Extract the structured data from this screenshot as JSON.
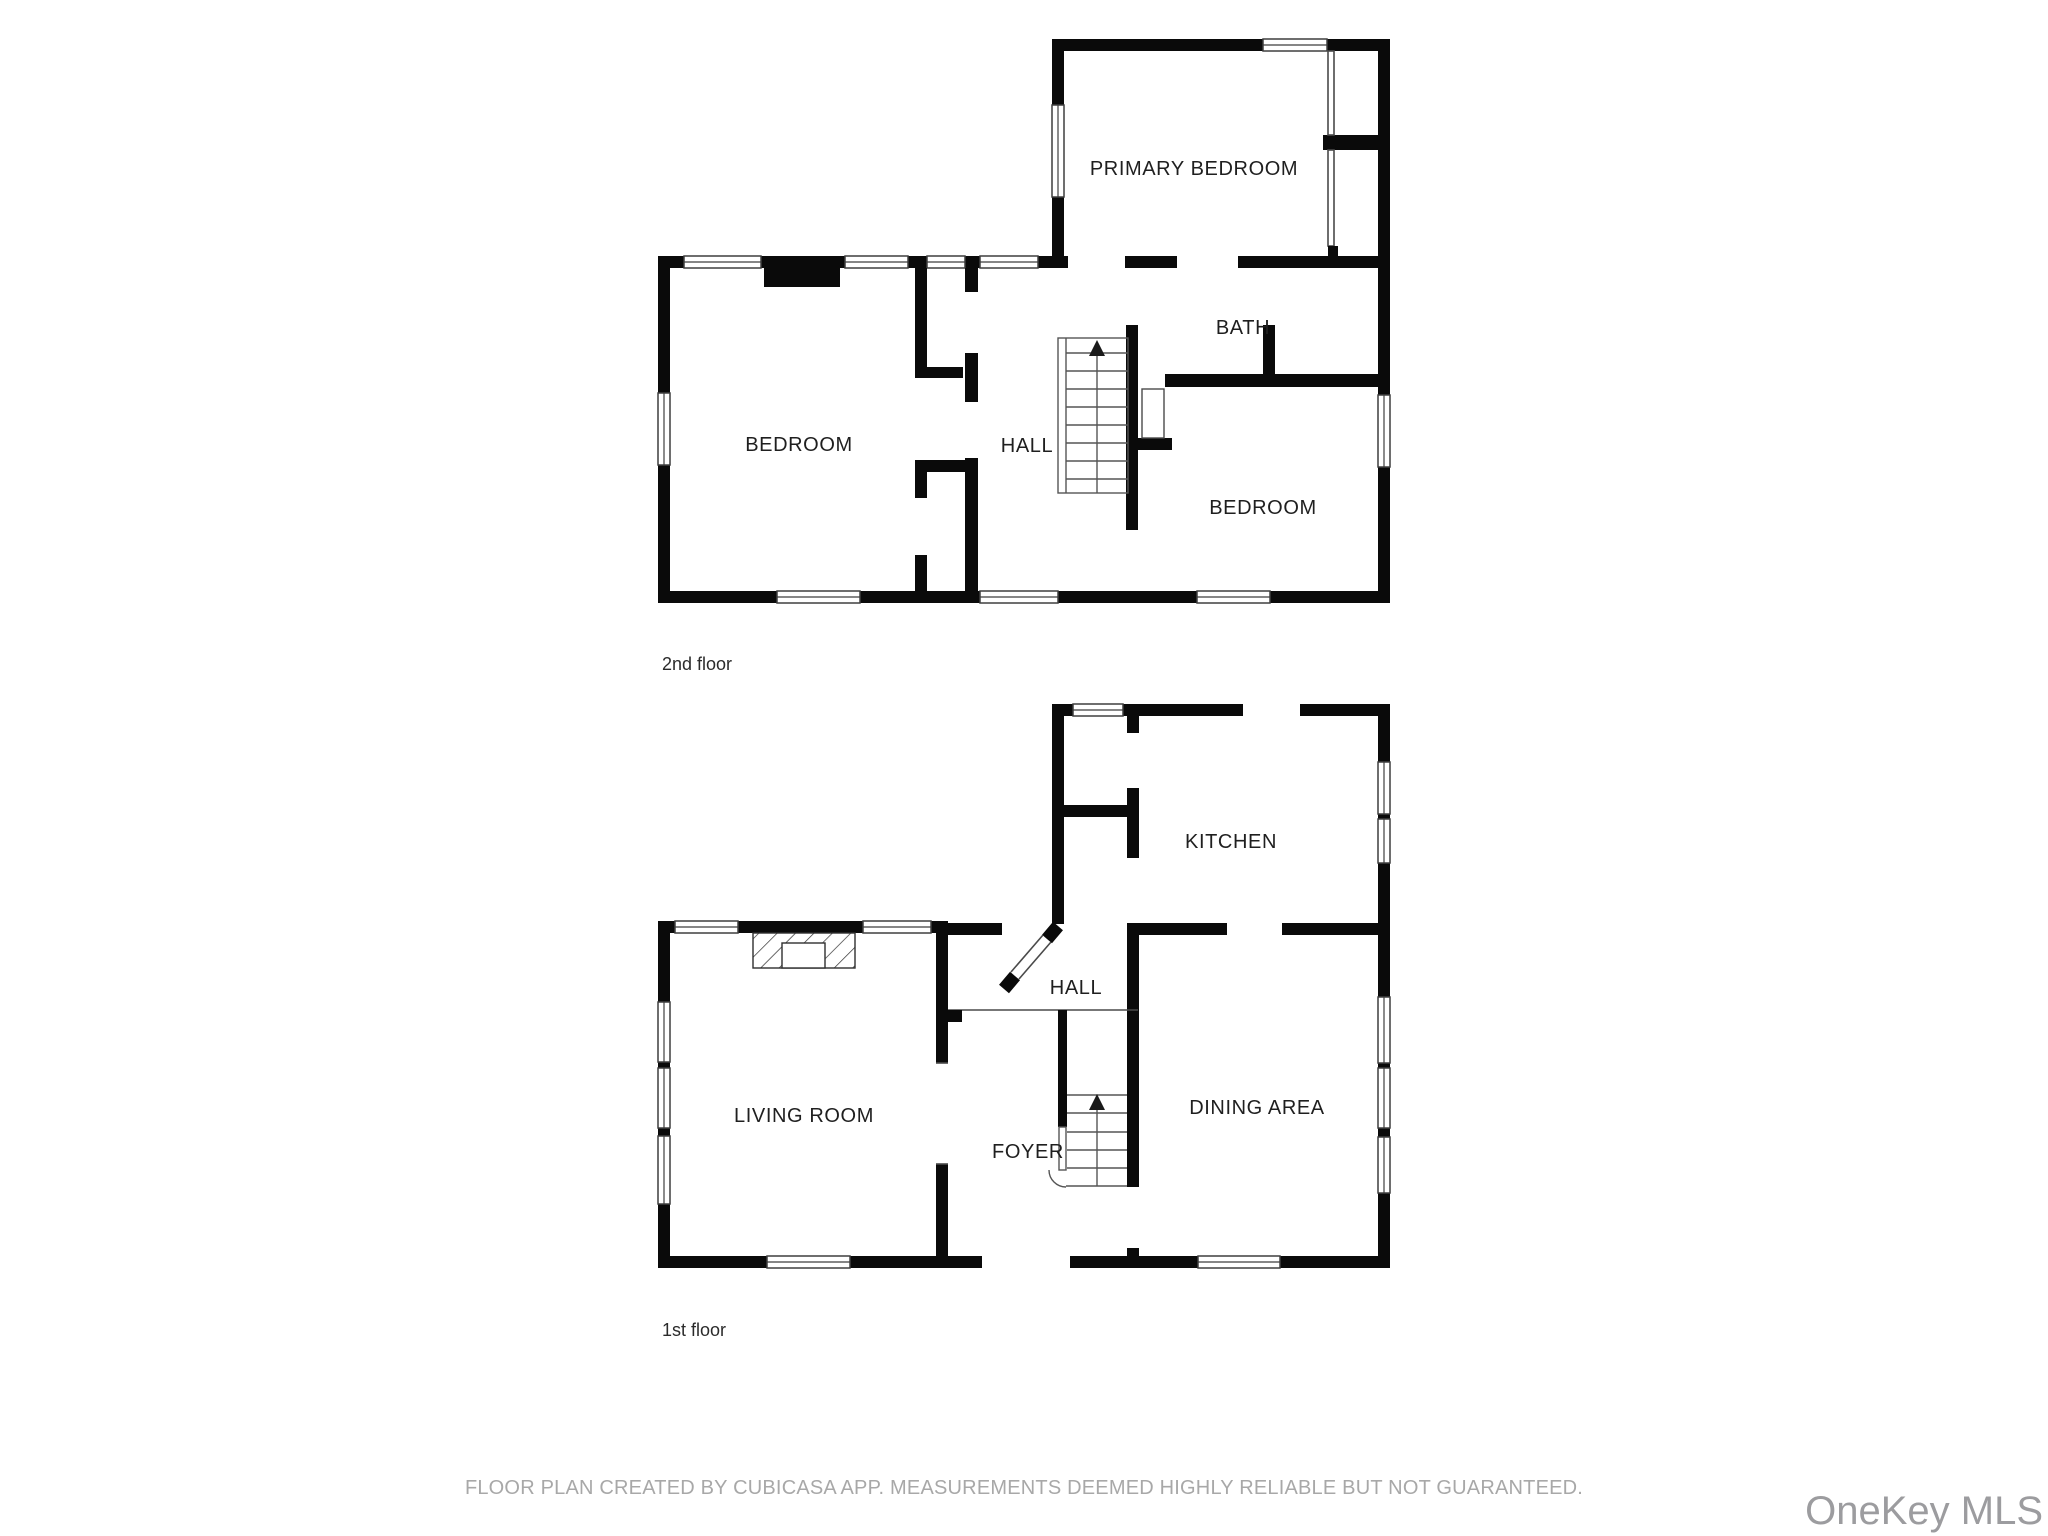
{
  "floors": [
    {
      "label": "2nd floor",
      "rooms": [
        {
          "name": "PRIMARY BEDROOM"
        },
        {
          "name": "BATH"
        },
        {
          "name": "BEDROOM"
        },
        {
          "name": "HALL"
        },
        {
          "name": "BEDROOM"
        }
      ]
    },
    {
      "label": "1st floor",
      "rooms": [
        {
          "name": "KITCHEN"
        },
        {
          "name": "HALL"
        },
        {
          "name": "LIVING ROOM"
        },
        {
          "name": "FOYER"
        },
        {
          "name": "DINING AREA"
        }
      ]
    }
  ],
  "footer": {
    "disclaimer": "FLOOR PLAN CREATED BY CUBICASA APP. MEASUREMENTS DEEMED HIGHLY RELIABLE BUT NOT GUARANTEED.",
    "watermark": "OneKey MLS"
  }
}
